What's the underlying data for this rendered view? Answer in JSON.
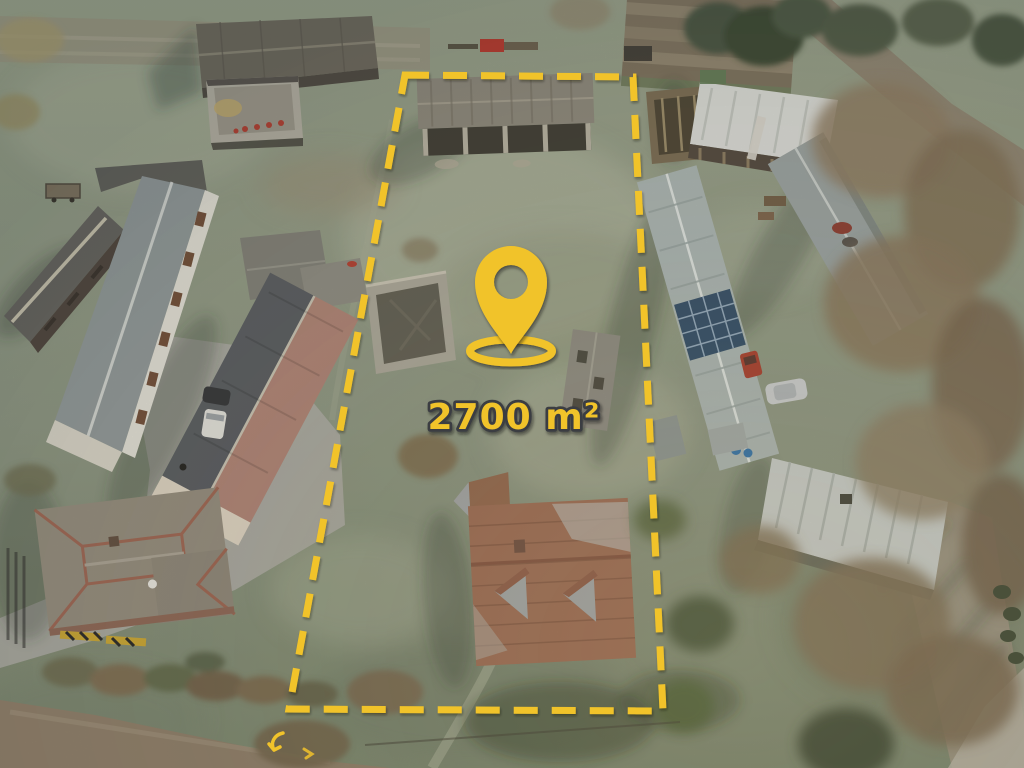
{
  "overlay": {
    "area_label": "2700 m²",
    "accent_color": "#F1C32B",
    "label_outline_color": "#3B3E43",
    "boundary": {
      "points_str": "405,75 633,77 663,711 289,709",
      "dash_pattern": "24 14",
      "stroke_width": "7"
    },
    "pin": {
      "transform": "translate(511,354)",
      "ring_transform": "translate(511,351)"
    },
    "arrow_main_transform": "translate(276,742)",
    "arrow_small_transform": "translate(309,753)"
  },
  "scene": {
    "setting": "winter aerial drone view of rural homestead plots with frosty grass",
    "marked_plot_contents": [
      "weathered timber barn with open bays",
      "roofless brick ruin",
      "small derelict outbuilding",
      "house with rust-brown tiled roof and gray frost patches"
    ],
    "surroundings": [
      "dark-roofed barn and walled courtyard at top left",
      "two long gray-roofed farm sheds on the left",
      "long building with dark/salmon two-tone roof",
      "hip-roofed farmhouse with garden at bottom left",
      "long metal-roofed sheds with solar panels on the right",
      "open shed with pale roof at top right",
      "large corrugated-roof building at bottom right",
      "plowed field strips and dirt roads at top right",
      "bare winter trees along the right side",
      "silver car, white van, red tractor, red farm machine"
    ],
    "palette": {
      "frost_grass": "#9AA38C",
      "shadow_grass": "#5F6B5C",
      "dirt_road": "#8E8370",
      "concrete": "#A9A9A1",
      "rust_roof": "#9A6850",
      "salmon_roof": "#AD8173",
      "metal_roof": "#A9B4B2"
    }
  }
}
